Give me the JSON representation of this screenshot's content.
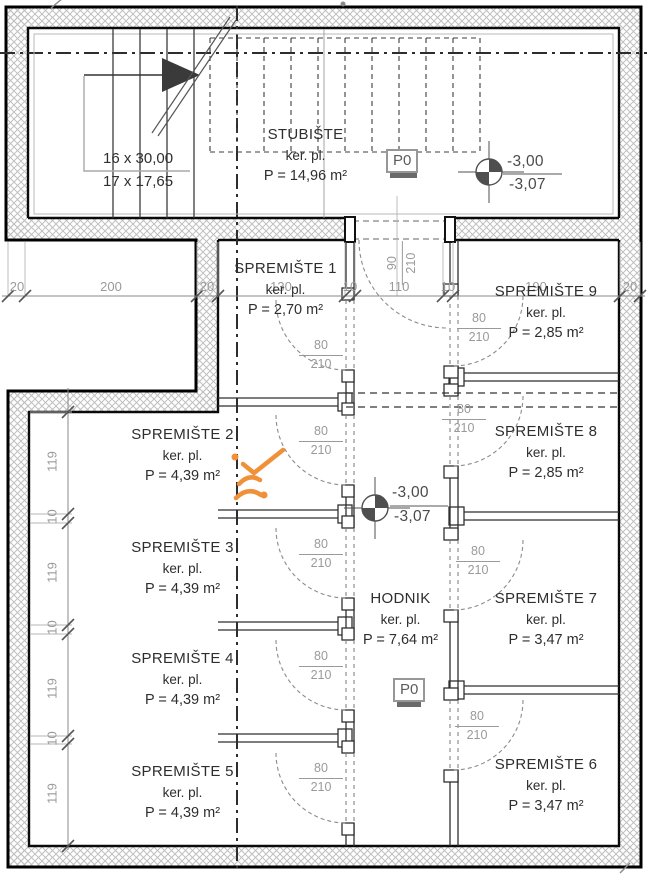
{
  "colors": {
    "wall_black": "#0a0a0a",
    "line_dark": "#2f2f2f",
    "dim_gray": "#9a9a9a",
    "text_dark": "#2e2e2e",
    "hatch_gray": "#bfbfbf",
    "level_gray": "#4f4f4f",
    "annotation_orange": "#f09038"
  },
  "stairwell": {
    "name": "STUBIŠTE",
    "material": "ker. pl.",
    "area": "P = 14,96 m²",
    "steps_top": "16 x 30,00",
    "steps_bottom": "17 x 17,65"
  },
  "corridor": {
    "name": "HODNIK",
    "material": "ker. pl.",
    "area": "P = 7,64 m²"
  },
  "rooms": [
    {
      "name": "SPREMIŠTE 1",
      "material": "ker. pl.",
      "area": "P = 2,70 m²"
    },
    {
      "name": "SPREMIŠTE 2",
      "material": "ker. pl.",
      "area": "P = 4,39 m²"
    },
    {
      "name": "SPREMIŠTE 3",
      "material": "ker. pl.",
      "area": "P = 4,39 m²"
    },
    {
      "name": "SPREMIŠTE 4",
      "material": "ker. pl.",
      "area": "P = 4,39 m²"
    },
    {
      "name": "SPREMIŠTE 5",
      "material": "ker. pl.",
      "area": "P = 4,39 m²"
    },
    {
      "name": "SPREMIŠTE 6",
      "material": "ker. pl.",
      "area": "P = 3,47 m²"
    },
    {
      "name": "SPREMIŠTE 7",
      "material": "ker. pl.",
      "area": "P = 3,47 m²"
    },
    {
      "name": "SPREMIŠTE 8",
      "material": "ker. pl.",
      "area": "P = 2,85 m²"
    },
    {
      "name": "SPREMIŠTE 9",
      "material": "ker. pl.",
      "area": "P = 2,85 m²"
    }
  ],
  "floor_label": {
    "text": "P0"
  },
  "level_marker": {
    "upper": "-3,00",
    "lower": "-3,07"
  },
  "doors": {
    "standard": {
      "width": "80",
      "height": "210"
    },
    "entrance": {
      "width": "90",
      "height": "210"
    }
  },
  "dimensions": {
    "top_row": [
      "20",
      "200",
      "20",
      "130",
      "10",
      "110",
      "10",
      "190",
      "20"
    ],
    "left_column": [
      "119",
      "10",
      "119",
      "10",
      "119",
      "10",
      "119"
    ]
  }
}
